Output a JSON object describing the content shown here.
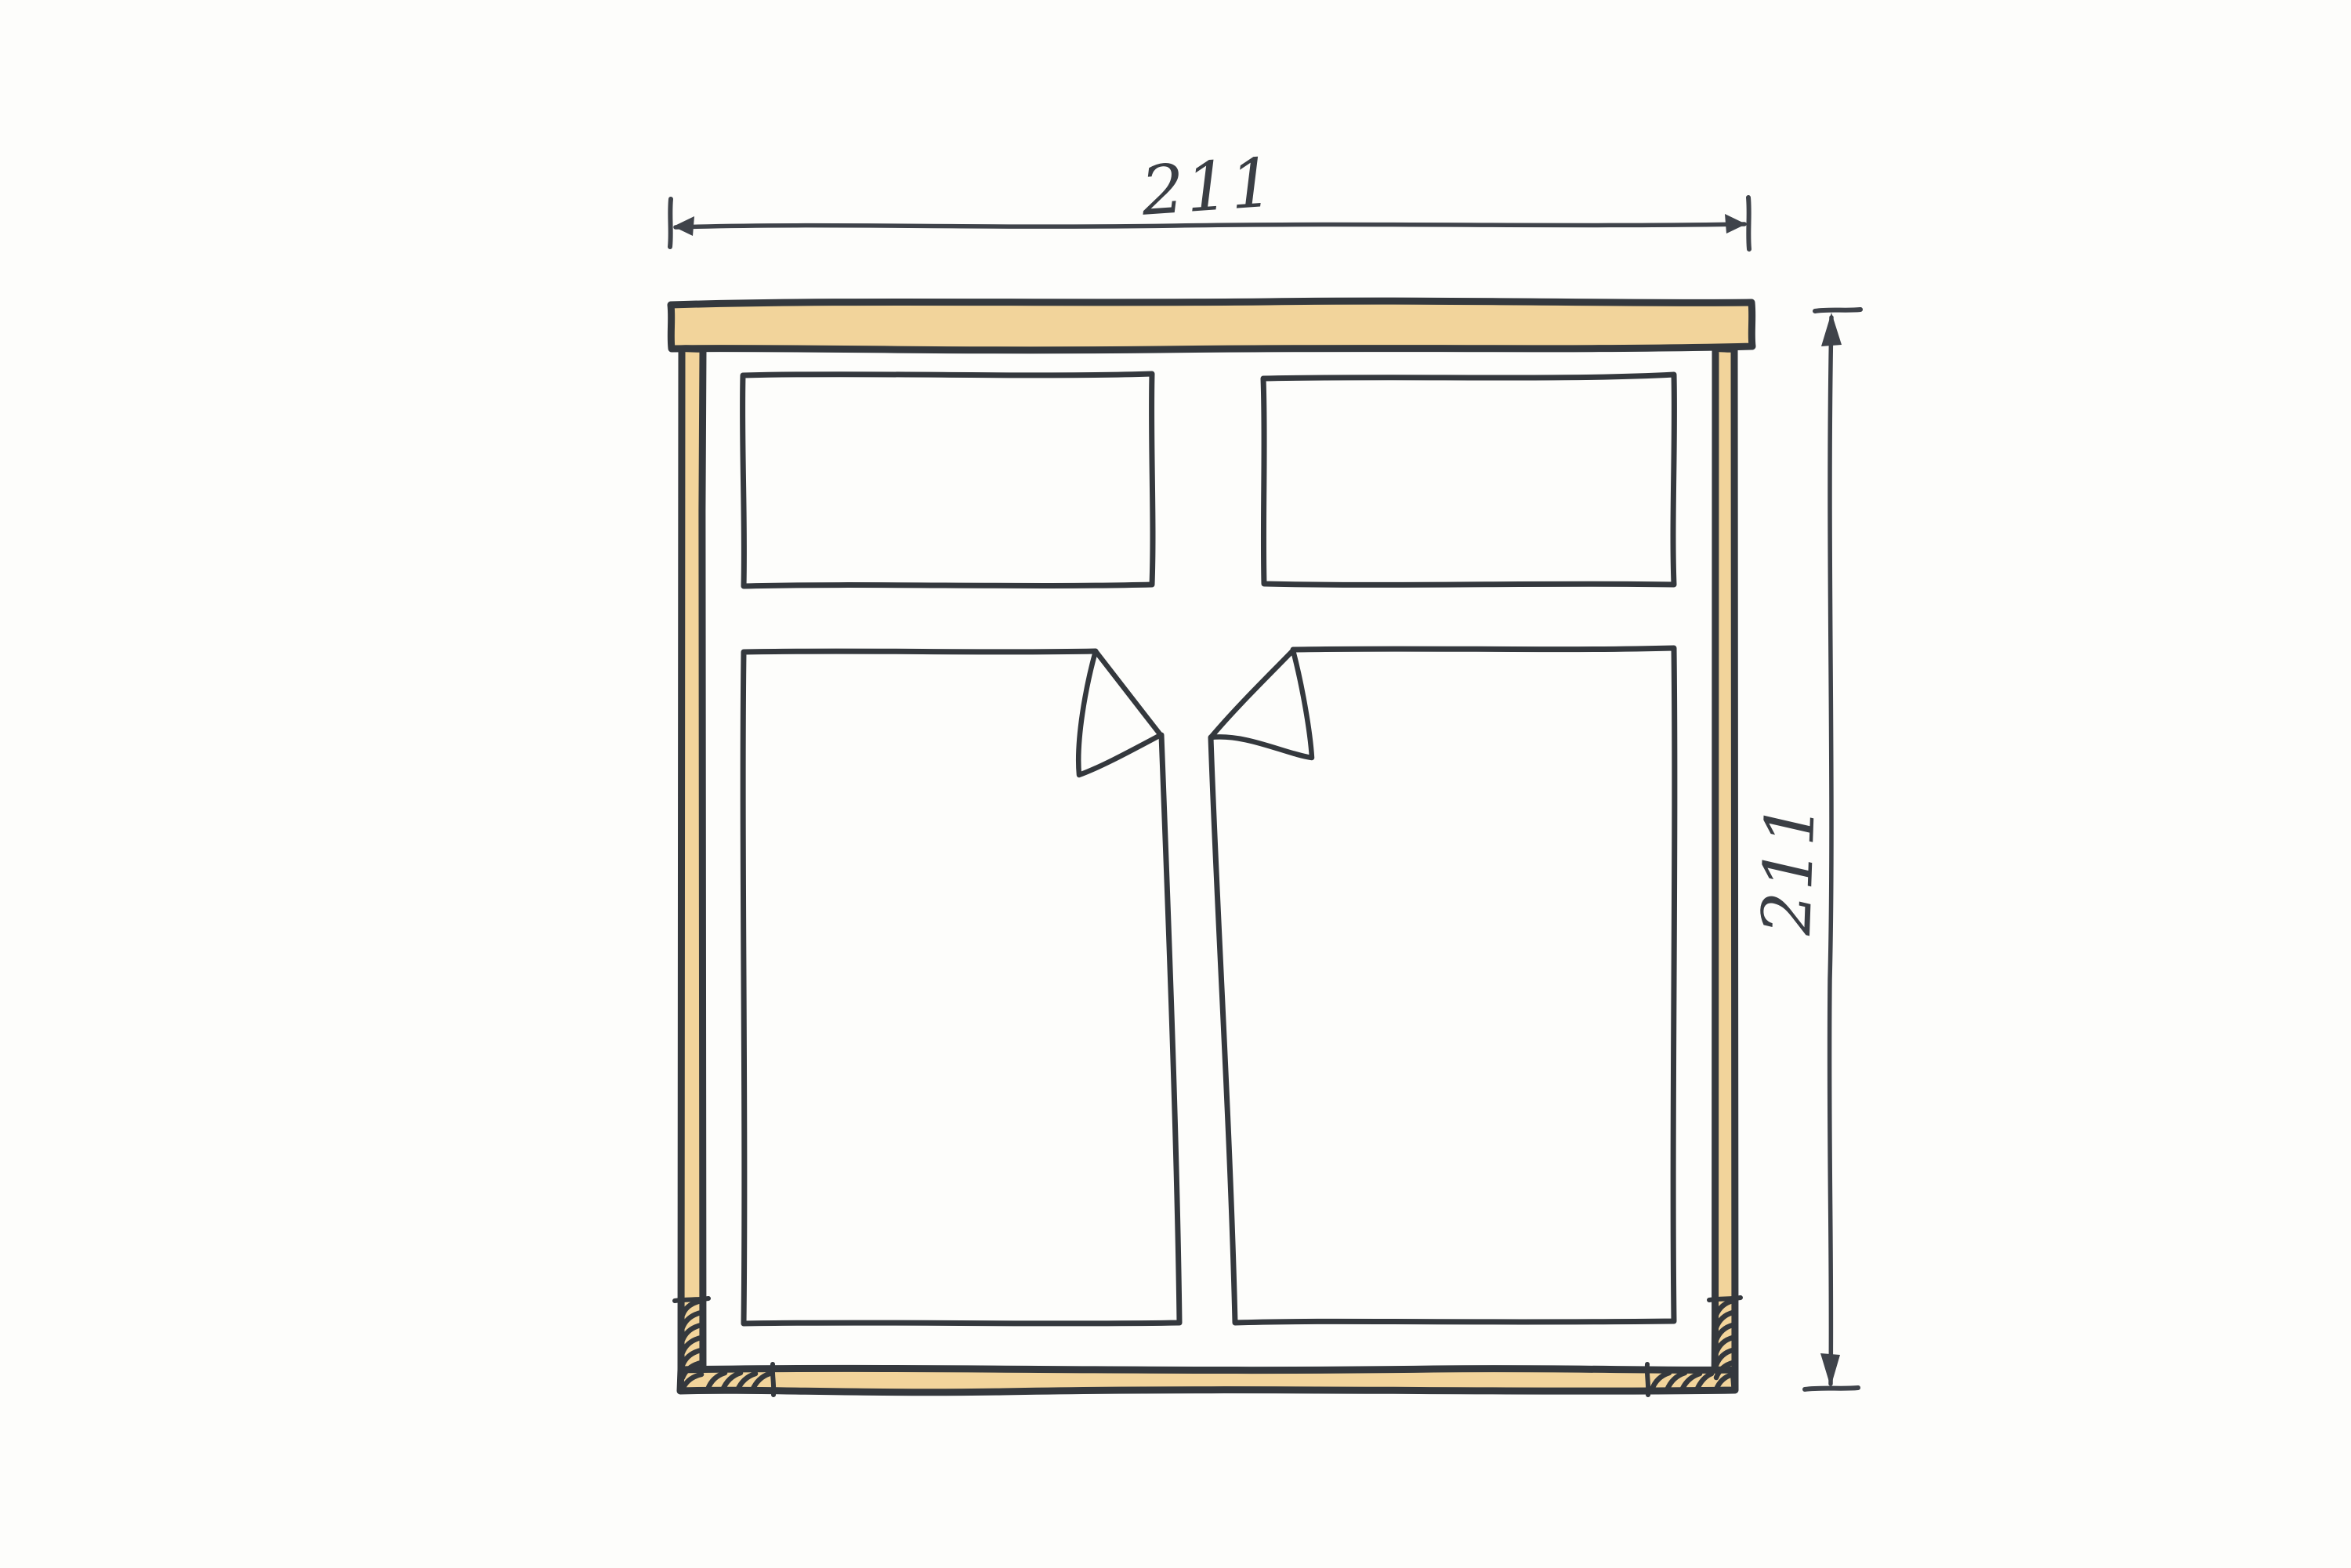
{
  "sketch": {
    "kind": "hand-drawn window elevation",
    "dimension_width": "211",
    "dimension_height": "211"
  },
  "colors": {
    "background": "#fdfdfb",
    "frame_fill": "#f2d49b",
    "ink": "#34383d",
    "dim_ink": "#3f434a",
    "text_ink": "#3a3e44"
  }
}
